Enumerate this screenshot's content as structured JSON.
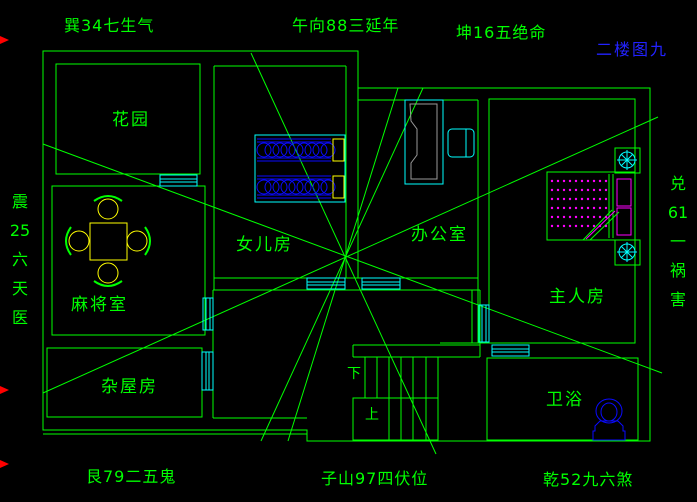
{
  "canvas": {
    "width": 697,
    "height": 502,
    "background": "#000000"
  },
  "palette": {
    "wall_green": "#00FF00",
    "fixture_cyan": "#00FFFF",
    "furniture_blue": "#0A0AFF",
    "pillow_yellow": "#FFFF00",
    "dot_magenta": "#FF00FF",
    "desk_gray": "#9a9a9a",
    "marker_red": "#FF0000",
    "title_blue": "#2222FF"
  },
  "title": "二楼图九",
  "compass": {
    "top_left": "巽34七生气",
    "top_center": "午向88三延年",
    "top_right": "坤16五绝命",
    "bottom_left": "艮79二五鬼",
    "bottom_center": "子山97四伏位",
    "bottom_right": "乾52九六煞",
    "left_vertical": [
      "震",
      "25",
      "六",
      "天",
      "医"
    ],
    "right_vertical": [
      "兑",
      "61",
      "一",
      "祸",
      "害"
    ]
  },
  "rooms": [
    {
      "label": "花园"
    },
    {
      "label": "麻将室"
    },
    {
      "label": "女儿房"
    },
    {
      "label": "办公室"
    },
    {
      "label": "主人房"
    },
    {
      "label": "杂屋房"
    },
    {
      "label": "卫浴"
    }
  ],
  "stairs": {
    "down_label": "下",
    "up_label": "上"
  }
}
